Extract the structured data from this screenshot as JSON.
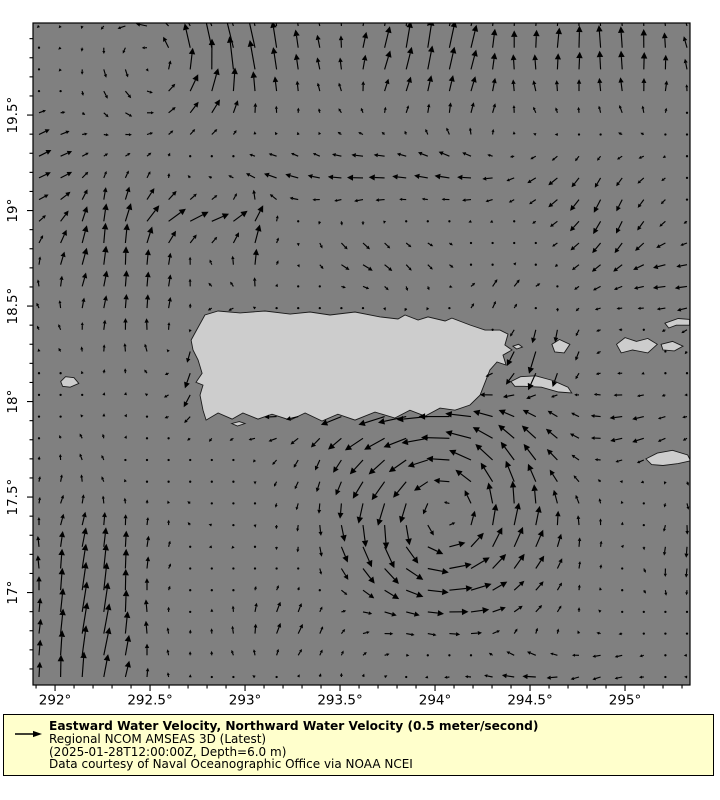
{
  "legend": {
    "background": "#ffffcc",
    "border_color": "#000000",
    "title": "Eastward Water Velocity, Northward Water Velocity (0.5 meter/second)",
    "model": "Regional NCOM AMSEAS 3D (Latest)",
    "time_depth": "(2025-01-28T12:00:00Z, Depth=6.0 m)",
    "credit": "Data courtesy of Naval Oceanographic Office via NOAA NCEI"
  },
  "chart_data": {
    "type": "quiver",
    "title": "",
    "xlabel": "",
    "ylabel": "",
    "legend_position": "bottom",
    "grid_lines": false,
    "colors": {
      "sea": "#808080",
      "land": "#cdcdcd",
      "coast": "#1a1a1a",
      "arrow": "#000000",
      "frame": "#000000"
    },
    "x_axis": {
      "min": 291.884,
      "max": 295.342,
      "major_ticks": [
        {
          "value": 292.0,
          "label": "292°"
        },
        {
          "value": 292.5,
          "label": "292.5°"
        },
        {
          "value": 293.0,
          "label": "293°"
        },
        {
          "value": 293.5,
          "label": "293.5°"
        },
        {
          "value": 294.0,
          "label": "294°"
        },
        {
          "value": 294.5,
          "label": "294.5°"
        },
        {
          "value": 295.0,
          "label": "295°"
        }
      ],
      "minor_step": 0.1
    },
    "y_axis": {
      "min": 16.516,
      "max": 19.982,
      "major_ticks": [
        {
          "value": 19.5,
          "label": "19.5°"
        },
        {
          "value": 19.0,
          "label": "19°"
        },
        {
          "value": 18.5,
          "label": "18.5°"
        },
        {
          "value": 18.0,
          "label": "18°"
        },
        {
          "value": 17.5,
          "label": "17.5°"
        },
        {
          "value": 17.0,
          "label": "17°"
        }
      ],
      "minor_step": 0.1
    },
    "reference_vector": {
      "value": 0.5,
      "units": "meter/second"
    },
    "arrow_grid": {
      "nx": 31,
      "ny": 31,
      "x0_px": 39,
      "dx_px": 21.6,
      "y0_px": 26,
      "dy_px": 21.7
    },
    "arrow_scale_px_per_ms": 50,
    "flow_model": {
      "background": {
        "u": -0.02,
        "v": 0.0
      },
      "noise_amplitude": 0.05,
      "vortices": [
        {
          "lon": 294.05,
          "lat": 17.42,
          "radius": 0.5,
          "strength": 1.05
        },
        {
          "lon": 292.62,
          "lat": 19.82,
          "radius": 0.4,
          "strength": 0.5
        }
      ],
      "currents": [
        {
          "lon": 292.18,
          "lat": 16.85,
          "rlon": 0.33,
          "rlat": 0.6,
          "u": 0.1,
          "v": 0.62
        },
        {
          "lon": 292.85,
          "lat": 18.18,
          "rlon": 0.18,
          "rlat": 0.28,
          "u": -0.18,
          "v": -0.55
        },
        {
          "lon": 292.35,
          "lat": 18.72,
          "rlon": 0.4,
          "rlat": 0.45,
          "u": 0.06,
          "v": 0.4
        },
        {
          "lon": 292.95,
          "lat": 19.9,
          "rlon": 0.45,
          "rlat": 0.33,
          "u": -0.1,
          "v": 0.55
        },
        {
          "lon": 294.0,
          "lat": 19.85,
          "rlon": 0.4,
          "rlat": 0.35,
          "u": 0.15,
          "v": 0.55
        },
        {
          "lon": 294.9,
          "lat": 19.9,
          "rlon": 0.45,
          "rlat": 0.35,
          "u": 0.0,
          "v": 0.5
        },
        {
          "lon": 294.55,
          "lat": 18.25,
          "rlon": 0.22,
          "rlat": 0.2,
          "u": -0.05,
          "v": -0.45
        },
        {
          "lon": 293.6,
          "lat": 17.93,
          "rlon": 0.65,
          "rlat": 0.13,
          "u": -0.28,
          "v": 0.0
        },
        {
          "lon": 295.2,
          "lat": 18.65,
          "rlon": 0.45,
          "rlat": 0.28,
          "u": -0.2,
          "v": -0.08
        },
        {
          "lon": 294.85,
          "lat": 19.05,
          "rlon": 0.3,
          "rlat": 0.25,
          "u": -0.12,
          "v": -0.3
        },
        {
          "lon": 293.7,
          "lat": 19.18,
          "rlon": 0.85,
          "rlat": 0.16,
          "u": -0.3,
          "v": 0.02
        },
        {
          "lon": 292.75,
          "lat": 18.95,
          "rlon": 0.33,
          "rlat": 0.12,
          "u": 0.38,
          "v": 0.06
        },
        {
          "lon": 293.7,
          "lat": 18.75,
          "rlon": 0.35,
          "rlat": 0.18,
          "u": 0.22,
          "v": -0.18
        },
        {
          "lon": 293.05,
          "lat": 18.8,
          "rlon": 0.12,
          "rlat": 0.25,
          "u": 0.0,
          "v": 0.35
        },
        {
          "lon": 294.35,
          "lat": 18.55,
          "rlon": 0.25,
          "rlat": 0.15,
          "u": 0.18,
          "v": 0.18
        },
        {
          "lon": 291.95,
          "lat": 19.2,
          "rlon": 0.25,
          "rlat": 0.35,
          "u": 0.25,
          "v": 0.1
        },
        {
          "lon": 295.0,
          "lat": 17.85,
          "rlon": 0.35,
          "rlat": 0.2,
          "u": -0.22,
          "v": -0.05
        },
        {
          "lon": 294.5,
          "lat": 16.6,
          "rlon": 0.55,
          "rlat": 0.15,
          "u": -0.28,
          "v": -0.02
        },
        {
          "lon": 293.3,
          "lat": 16.8,
          "rlon": 0.4,
          "rlat": 0.25,
          "u": 0.05,
          "v": 0.25
        },
        {
          "lon": 295.3,
          "lat": 17.3,
          "rlon": 0.25,
          "rlat": 0.4,
          "u": 0.04,
          "v": -0.18
        }
      ]
    },
    "land": {
      "puerto_rico": [
        [
          292.716,
          18.322
        ],
        [
          292.742,
          18.369
        ],
        [
          292.789,
          18.453
        ],
        [
          292.858,
          18.474
        ],
        [
          292.974,
          18.464
        ],
        [
          293.105,
          18.474
        ],
        [
          293.237,
          18.458
        ],
        [
          293.342,
          18.469
        ],
        [
          293.447,
          18.453
        ],
        [
          293.579,
          18.469
        ],
        [
          293.711,
          18.443
        ],
        [
          293.805,
          18.432
        ],
        [
          293.842,
          18.453
        ],
        [
          293.911,
          18.427
        ],
        [
          293.963,
          18.443
        ],
        [
          294.053,
          18.422
        ],
        [
          294.089,
          18.437
        ],
        [
          294.184,
          18.401
        ],
        [
          294.263,
          18.374
        ],
        [
          294.342,
          18.374
        ],
        [
          294.384,
          18.353
        ],
        [
          294.368,
          18.296
        ],
        [
          294.405,
          18.27
        ],
        [
          294.358,
          18.243
        ],
        [
          294.374,
          18.191
        ],
        [
          294.326,
          18.207
        ],
        [
          294.289,
          18.165
        ],
        [
          294.237,
          18.034
        ],
        [
          294.184,
          17.982
        ],
        [
          294.105,
          17.955
        ],
        [
          294.026,
          17.966
        ],
        [
          293.947,
          17.924
        ],
        [
          293.868,
          17.955
        ],
        [
          293.789,
          17.914
        ],
        [
          293.684,
          17.945
        ],
        [
          293.579,
          17.903
        ],
        [
          293.489,
          17.934
        ],
        [
          293.405,
          17.898
        ],
        [
          293.316,
          17.94
        ],
        [
          293.237,
          17.903
        ],
        [
          293.142,
          17.934
        ],
        [
          293.068,
          17.908
        ],
        [
          292.989,
          17.94
        ],
        [
          292.932,
          17.908
        ],
        [
          292.858,
          17.94
        ],
        [
          292.795,
          17.903
        ],
        [
          292.779,
          17.955
        ],
        [
          292.763,
          18.034
        ],
        [
          292.779,
          18.086
        ],
        [
          292.742,
          18.101
        ],
        [
          292.774,
          18.148
        ],
        [
          292.753,
          18.217
        ],
        [
          292.726,
          18.27
        ]
      ],
      "islands": [
        {
          "name": "mona",
          "points": [
            [
              292.03,
              18.105
            ],
            [
              292.055,
              18.13
            ],
            [
              292.1,
              18.125
            ],
            [
              292.125,
              18.095
            ],
            [
              292.08,
              18.075
            ],
            [
              292.04,
              18.08
            ]
          ]
        },
        {
          "name": "vieques",
          "points": [
            [
              294.4,
              18.105
            ],
            [
              294.45,
              18.13
            ],
            [
              294.53,
              18.135
            ],
            [
              294.62,
              18.11
            ],
            [
              294.7,
              18.075
            ],
            [
              294.72,
              18.045
            ],
            [
              294.65,
              18.05
            ],
            [
              294.56,
              18.075
            ],
            [
              294.47,
              18.08
            ],
            [
              294.42,
              18.08
            ]
          ]
        },
        {
          "name": "culebra",
          "points": [
            [
              294.615,
              18.3
            ],
            [
              294.655,
              18.325
            ],
            [
              294.71,
              18.3
            ],
            [
              294.68,
              18.255
            ],
            [
              294.63,
              18.26
            ]
          ]
        },
        {
          "name": "st-thomas",
          "points": [
            [
              294.955,
              18.3
            ],
            [
              295.0,
              18.335
            ],
            [
              295.06,
              18.315
            ],
            [
              295.12,
              18.33
            ],
            [
              295.17,
              18.3
            ],
            [
              295.12,
              18.255
            ],
            [
              295.04,
              18.27
            ],
            [
              294.98,
              18.255
            ]
          ]
        },
        {
          "name": "st-john",
          "points": [
            [
              295.19,
              18.3
            ],
            [
              295.25,
              18.315
            ],
            [
              295.305,
              18.29
            ],
            [
              295.26,
              18.265
            ],
            [
              295.2,
              18.27
            ]
          ]
        },
        {
          "name": "tortola",
          "points": [
            [
              295.21,
              18.41
            ],
            [
              295.28,
              18.435
            ],
            [
              295.34,
              18.43
            ],
            [
              295.34,
              18.4
            ],
            [
              295.27,
              18.4
            ],
            [
              295.23,
              18.385
            ]
          ]
        },
        {
          "name": "st-croix",
          "points": [
            [
              295.11,
              17.7
            ],
            [
              295.17,
              17.73
            ],
            [
              295.25,
              17.745
            ],
            [
              295.33,
              17.72
            ],
            [
              295.345,
              17.69
            ],
            [
              295.28,
              17.675
            ],
            [
              295.2,
              17.665
            ],
            [
              295.14,
              17.67
            ]
          ]
        },
        {
          "name": "caja-de-muertos",
          "points": [
            [
              292.93,
              17.885
            ],
            [
              292.97,
              17.895
            ],
            [
              293.0,
              17.885
            ],
            [
              292.96,
              17.872
            ]
          ]
        },
        {
          "name": "islets-east",
          "points": [
            [
              294.41,
              18.29
            ],
            [
              294.44,
              18.3
            ],
            [
              294.46,
              18.285
            ],
            [
              294.43,
              18.275
            ]
          ]
        }
      ]
    }
  }
}
